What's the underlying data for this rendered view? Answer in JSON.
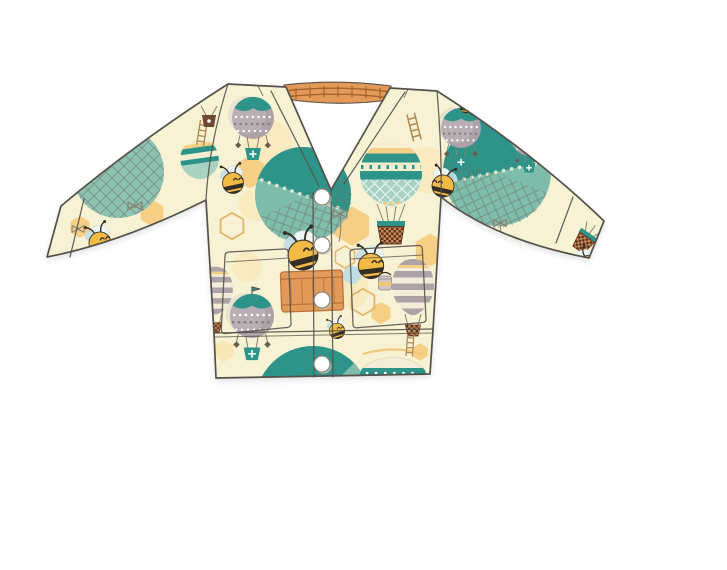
{
  "image": {
    "width": 727,
    "height": 570,
    "background": "#ffffff",
    "alt": "Flat-lay product mockup of a cream baby cardigan printed with teal hot-air balloons, honeybees, honeycomb hexagons and ladders; V-neck, four white snap buttons, two patch pockets, ribbed cuffs and hem"
  },
  "garment": {
    "type": "baby cardigan",
    "neckline": "V-neck",
    "closure": "snap buttons",
    "snap_button_count": 4,
    "pocket_count": 2,
    "sleeves": "long",
    "base_fabric": "cream with all-over print"
  },
  "print_motifs": [
    "teal-circle-hot-air-balloon-with-net",
    "teal-striped-hot-air-balloon-with-basket",
    "gray-balloon-with-teal-scalloped-cap",
    "mauve-striped-tall-balloon",
    "honeybee",
    "honeycomb-hexagon",
    "honey-drip",
    "orange-hive-crate",
    "honey-pot",
    "ladder",
    "ribbon-bow",
    "hanging-star-charm",
    "checkered-balloon-basket"
  ],
  "colors": {
    "background": "#ffffff",
    "fabric_cream": "#f8f2d5",
    "outline": "#55514a",
    "teal_dark": "#2f948a",
    "teal_mid": "#7ebcab",
    "teal_light": "#a9d2c3",
    "hex_yellow": "#f6cf87",
    "hex_light": "#f9e7b6",
    "honey": "#f0c878",
    "orange": "#e39a58",
    "orange_dark": "#b9713b",
    "bee_yellow": "#f3ba45",
    "bee_dark": "#322d26",
    "mauve": "#aca2a7",
    "mauve_light": "#cfc6ca",
    "brown": "#6f4631",
    "brown_light": "#c98a52",
    "blue_pale": "#c3dde5",
    "string": "#8a8070",
    "net_line": "#6f695c",
    "ladder": "#b08a52",
    "snap_stroke": "#8b887e"
  }
}
